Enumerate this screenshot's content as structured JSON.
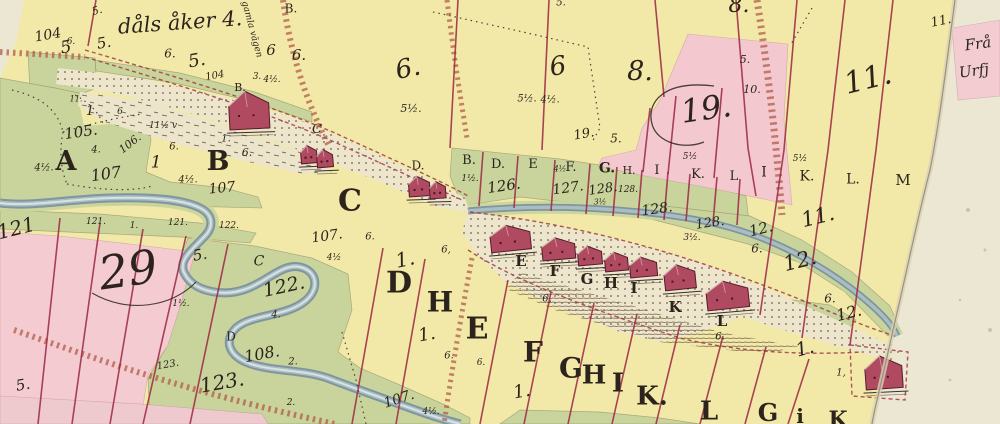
{
  "meta": {
    "document_type": "historical hand-drawn cadastral map (scanned sheet)",
    "main_inscription": "dåls åker 4.",
    "road_inscription": "gamla vägen",
    "neighbor_sheet_text": [
      "Frå",
      "Urfj"
    ]
  },
  "palette": {
    "paper": "#ece7d2",
    "field_yellow": "#f2e9a9",
    "meadow_green": "#c8d49b",
    "parcel_pink": "#f3cbd1",
    "boundary_red": "#9e2b45",
    "road_brown": "#b05844",
    "river_gray": "#7f969e",
    "house_red": "#b04a60",
    "ink": "#2c241c"
  },
  "map": {
    "labels": [
      {
        "t": "5.",
        "x": 97,
        "y": 11,
        "s": 11,
        "r": -15
      },
      {
        "t": "dåls åker 4.",
        "x": 180,
        "y": 24,
        "s": 21,
        "r": -4
      },
      {
        "t": "B.",
        "x": 291,
        "y": 9,
        "s": 12,
        "u": 1
      },
      {
        "t": "104",
        "x": 48,
        "y": 36,
        "s": 14,
        "r": -10
      },
      {
        "t": "6.",
        "x": 71,
        "y": 43,
        "s": 9
      },
      {
        "t": "5",
        "x": 66,
        "y": 49,
        "s": 17,
        "r": -10
      },
      {
        "t": "5.",
        "x": 104,
        "y": 44,
        "s": 15,
        "r": -10
      },
      {
        "t": "6.",
        "x": 170,
        "y": 54,
        "s": 12
      },
      {
        "t": "5.",
        "x": 197,
        "y": 62,
        "s": 18,
        "r": -10
      },
      {
        "t": "104",
        "x": 215,
        "y": 77,
        "s": 10,
        "r": -10
      },
      {
        "t": "gamla vägen",
        "x": 251,
        "y": 30,
        "s": 9,
        "r": 75
      },
      {
        "t": "6",
        "x": 271,
        "y": 51,
        "s": 15
      },
      {
        "t": "6.",
        "x": 299,
        "y": 56,
        "s": 15
      },
      {
        "t": "3.",
        "x": 257,
        "y": 78,
        "s": 9
      },
      {
        "t": "4½.",
        "x": 272,
        "y": 81,
        "s": 9
      },
      {
        "t": "B.",
        "x": 240,
        "y": 88,
        "s": 11,
        "u": 1
      },
      {
        "t": "6.",
        "x": 408,
        "y": 70,
        "s": 26,
        "r": -12
      },
      {
        "t": "5½.",
        "x": 411,
        "y": 109,
        "s": 11
      },
      {
        "t": "6",
        "x": 558,
        "y": 68,
        "s": 26,
        "r": -8
      },
      {
        "t": "5½.",
        "x": 527,
        "y": 100,
        "s": 10
      },
      {
        "t": "4½.",
        "x": 550,
        "y": 101,
        "s": 10
      },
      {
        "t": "8.",
        "x": 640,
        "y": 73,
        "s": 27
      },
      {
        "t": "5.",
        "x": 561,
        "y": 4,
        "s": 10
      },
      {
        "t": "8.",
        "x": 739,
        "y": 7,
        "s": 22
      },
      {
        "t": "5.",
        "x": 745,
        "y": 60,
        "s": 11
      },
      {
        "t": "19.",
        "x": 584,
        "y": 135,
        "s": 13,
        "r": -10
      },
      {
        "t": "5.",
        "x": 616,
        "y": 139,
        "s": 12
      },
      {
        "t": "19.",
        "x": 706,
        "y": 110,
        "s": 32,
        "r": -8
      },
      {
        "t": "10.",
        "x": 752,
        "y": 90,
        "s": 11
      },
      {
        "t": "11.",
        "x": 941,
        "y": 22,
        "s": 13,
        "r": -12
      },
      {
        "t": "11.",
        "x": 868,
        "y": 81,
        "s": 30,
        "r": -14
      },
      {
        "t": "Frå",
        "x": 978,
        "y": 45,
        "s": 15,
        "r": -8
      },
      {
        "t": "Urfj",
        "x": 974,
        "y": 72,
        "s": 15,
        "r": -8
      },
      {
        "t": "11.",
        "x": 76,
        "y": 100,
        "s": 8
      },
      {
        "t": "1",
        "x": 90,
        "y": 112,
        "s": 13
      },
      {
        "t": "6",
        "x": 120,
        "y": 113,
        "s": 9
      },
      {
        "t": "105.",
        "x": 81,
        "y": 133,
        "s": 15,
        "r": -8
      },
      {
        "t": "106.",
        "x": 130,
        "y": 144,
        "s": 11,
        "r": -38
      },
      {
        "t": "11½ v",
        "x": 163,
        "y": 127,
        "s": 9
      },
      {
        "t": "A",
        "x": 66,
        "y": 163,
        "s": 27,
        "b": 1,
        "u": 1
      },
      {
        "t": "4½.",
        "x": 44,
        "y": 169,
        "s": 10
      },
      {
        "t": "4.",
        "x": 96,
        "y": 151,
        "s": 10
      },
      {
        "t": "107",
        "x": 106,
        "y": 175,
        "s": 16,
        "r": -8
      },
      {
        "t": "6.",
        "x": 174,
        "y": 148,
        "s": 10
      },
      {
        "t": "1",
        "x": 156,
        "y": 164,
        "s": 17
      },
      {
        "t": "1.",
        "x": 226,
        "y": 140,
        "s": 10
      },
      {
        "t": "B",
        "x": 218,
        "y": 163,
        "s": 27,
        "b": 1,
        "u": 1
      },
      {
        "t": "6.",
        "x": 247,
        "y": 153,
        "s": 11
      },
      {
        "t": "4½.",
        "x": 188,
        "y": 181,
        "s": 10
      },
      {
        "t": "107",
        "x": 222,
        "y": 189,
        "s": 14,
        "r": -6
      },
      {
        "t": "C",
        "x": 317,
        "y": 130,
        "s": 13
      },
      {
        "t": "121",
        "x": 16,
        "y": 229,
        "s": 20,
        "r": -14
      },
      {
        "t": "121.",
        "x": 96,
        "y": 223,
        "s": 9
      },
      {
        "t": "1.",
        "x": 134,
        "y": 227,
        "s": 9
      },
      {
        "t": "121.",
        "x": 178,
        "y": 224,
        "s": 9
      },
      {
        "t": "122.",
        "x": 229,
        "y": 227,
        "s": 9
      },
      {
        "t": "29",
        "x": 128,
        "y": 272,
        "s": 46,
        "r": -8
      },
      {
        "t": "5.",
        "x": 200,
        "y": 256,
        "s": 15,
        "r": -10
      },
      {
        "t": "1½.",
        "x": 181,
        "y": 305,
        "s": 9
      },
      {
        "t": "C",
        "x": 259,
        "y": 262,
        "s": 14
      },
      {
        "t": "122.",
        "x": 284,
        "y": 288,
        "s": 19,
        "r": -12
      },
      {
        "t": "4.",
        "x": 276,
        "y": 316,
        "s": 10
      },
      {
        "t": "D",
        "x": 231,
        "y": 337,
        "s": 12,
        "u": 1
      },
      {
        "t": "108.",
        "x": 262,
        "y": 355,
        "s": 16,
        "r": -10
      },
      {
        "t": "2.",
        "x": 293,
        "y": 363,
        "s": 10
      },
      {
        "t": "123.",
        "x": 168,
        "y": 366,
        "s": 10,
        "r": -10
      },
      {
        "t": "123.",
        "x": 222,
        "y": 383,
        "s": 20,
        "r": -10
      },
      {
        "t": "5.",
        "x": 23,
        "y": 386,
        "s": 15,
        "r": -10
      },
      {
        "t": "2.",
        "x": 291,
        "y": 404,
        "s": 9
      },
      {
        "t": "C",
        "x": 350,
        "y": 203,
        "s": 30,
        "b": 1,
        "u": 1
      },
      {
        "t": "107.",
        "x": 327,
        "y": 237,
        "s": 14,
        "r": -8
      },
      {
        "t": "6.",
        "x": 370,
        "y": 238,
        "s": 10
      },
      {
        "t": "4½",
        "x": 334,
        "y": 259,
        "s": 9
      },
      {
        "t": "D.",
        "x": 418,
        "y": 166,
        "s": 12,
        "u": 1
      },
      {
        "t": "B.",
        "x": 469,
        "y": 161,
        "s": 13,
        "u": 1
      },
      {
        "t": "1½.",
        "x": 470,
        "y": 180,
        "s": 9
      },
      {
        "t": "D.",
        "x": 498,
        "y": 165,
        "s": 13,
        "u": 1
      },
      {
        "t": "126.",
        "x": 504,
        "y": 187,
        "s": 15,
        "r": -8
      },
      {
        "t": "E",
        "x": 533,
        "y": 165,
        "s": 13,
        "u": 1
      },
      {
        "t": "4½",
        "x": 560,
        "y": 170,
        "s": 8
      },
      {
        "t": "F.",
        "x": 571,
        "y": 168,
        "s": 13,
        "u": 1
      },
      {
        "t": "127.",
        "x": 568,
        "y": 189,
        "s": 14,
        "r": -8
      },
      {
        "t": "G.",
        "x": 607,
        "y": 169,
        "s": 14,
        "b": 1,
        "u": 1
      },
      {
        "t": "128.",
        "x": 603,
        "y": 190,
        "s": 13,
        "r": -8
      },
      {
        "t": "H.",
        "x": 629,
        "y": 171,
        "s": 11,
        "u": 1
      },
      {
        "t": "128.",
        "x": 628,
        "y": 191,
        "s": 9
      },
      {
        "t": "3½",
        "x": 600,
        "y": 203,
        "s": 8
      },
      {
        "t": "128.",
        "x": 657,
        "y": 210,
        "s": 14,
        "r": -8
      },
      {
        "t": "128.",
        "x": 710,
        "y": 224,
        "s": 13,
        "r": -8
      },
      {
        "t": "3½.",
        "x": 692,
        "y": 239,
        "s": 9
      },
      {
        "t": "I",
        "x": 657,
        "y": 171,
        "s": 13,
        "u": 1
      },
      {
        "t": "K.",
        "x": 698,
        "y": 175,
        "s": 13,
        "u": 1
      },
      {
        "t": "L",
        "x": 734,
        "y": 177,
        "s": 13,
        "u": 1
      },
      {
        "t": "5½",
        "x": 690,
        "y": 158,
        "s": 9
      },
      {
        "t": "I",
        "x": 764,
        "y": 173,
        "s": 14,
        "u": 1
      },
      {
        "t": "K.",
        "x": 807,
        "y": 177,
        "s": 14,
        "u": 1
      },
      {
        "t": "L.",
        "x": 853,
        "y": 180,
        "s": 14,
        "u": 1
      },
      {
        "t": "M",
        "x": 903,
        "y": 181,
        "s": 15,
        "u": 1
      },
      {
        "t": "5½",
        "x": 800,
        "y": 160,
        "s": 9
      },
      {
        "t": "11.",
        "x": 818,
        "y": 218,
        "s": 21,
        "r": -14
      },
      {
        "t": "12.",
        "x": 761,
        "y": 230,
        "s": 15,
        "r": -14
      },
      {
        "t": "6.",
        "x": 757,
        "y": 249,
        "s": 12
      },
      {
        "t": "12.",
        "x": 800,
        "y": 262,
        "s": 21,
        "r": -14
      },
      {
        "t": "6.",
        "x": 830,
        "y": 299,
        "s": 12
      },
      {
        "t": "12.",
        "x": 849,
        "y": 314,
        "s": 16,
        "r": -14
      },
      {
        "t": "1.",
        "x": 805,
        "y": 350,
        "s": 19,
        "r": -15
      },
      {
        "t": "1,",
        "x": 841,
        "y": 374,
        "s": 10
      },
      {
        "t": "E",
        "x": 521,
        "y": 262,
        "s": 15,
        "b": 1,
        "u": 1
      },
      {
        "t": "F",
        "x": 555,
        "y": 272,
        "s": 15,
        "b": 1,
        "u": 1
      },
      {
        "t": "G",
        "x": 587,
        "y": 280,
        "s": 15,
        "b": 1,
        "u": 1
      },
      {
        "t": "H",
        "x": 611,
        "y": 284,
        "s": 15,
        "b": 1,
        "u": 1
      },
      {
        "t": "I",
        "x": 634,
        "y": 289,
        "s": 15,
        "b": 1,
        "u": 1
      },
      {
        "t": "K",
        "x": 675,
        "y": 308,
        "s": 15,
        "b": 1,
        "u": 1
      },
      {
        "t": "L",
        "x": 722,
        "y": 322,
        "s": 15,
        "b": 1,
        "u": 1
      },
      {
        "t": "1.",
        "x": 405,
        "y": 260,
        "s": 20,
        "r": -12
      },
      {
        "t": "D",
        "x": 399,
        "y": 285,
        "s": 30,
        "b": 1,
        "u": 1
      },
      {
        "t": "6,",
        "x": 446,
        "y": 251,
        "s": 10
      },
      {
        "t": "H",
        "x": 440,
        "y": 304,
        "s": 28,
        "b": 1,
        "u": 1
      },
      {
        "t": "1.",
        "x": 427,
        "y": 336,
        "s": 18,
        "r": -10
      },
      {
        "t": "E",
        "x": 477,
        "y": 331,
        "s": 30,
        "b": 1,
        "u": 1
      },
      {
        "t": "6.",
        "x": 449,
        "y": 357,
        "s": 10
      },
      {
        "t": "6.",
        "x": 481,
        "y": 364,
        "s": 9
      },
      {
        "t": "F",
        "x": 533,
        "y": 354,
        "s": 28,
        "b": 1,
        "u": 1
      },
      {
        "t": "1.",
        "x": 522,
        "y": 393,
        "s": 18,
        "r": -10
      },
      {
        "t": "6,",
        "x": 547,
        "y": 300,
        "s": 10
      },
      {
        "t": "G",
        "x": 571,
        "y": 370,
        "s": 28,
        "b": 1,
        "u": 1
      },
      {
        "t": "H",
        "x": 594,
        "y": 377,
        "s": 26,
        "b": 1,
        "u": 1
      },
      {
        "t": "I",
        "x": 618,
        "y": 385,
        "s": 26,
        "b": 1,
        "u": 1
      },
      {
        "t": "K.",
        "x": 652,
        "y": 398,
        "s": 26,
        "b": 1,
        "u": 1
      },
      {
        "t": "L",
        "x": 709,
        "y": 413,
        "s": 26,
        "b": 1,
        "u": 1
      },
      {
        "t": "6.",
        "x": 720,
        "y": 338,
        "s": 10
      },
      {
        "t": "G",
        "x": 768,
        "y": 414,
        "s": 24,
        "b": 1,
        "u": 1
      },
      {
        "t": "i",
        "x": 800,
        "y": 417,
        "s": 20,
        "b": 1,
        "u": 1
      },
      {
        "t": "K",
        "x": 838,
        "y": 421,
        "s": 22,
        "b": 1,
        "u": 1
      },
      {
        "t": "107.",
        "x": 399,
        "y": 400,
        "s": 14,
        "r": -18
      },
      {
        "t": "4½.",
        "x": 431,
        "y": 413,
        "s": 9
      }
    ],
    "houses": [
      {
        "x": 228,
        "y": 92,
        "w": 40,
        "h": 38,
        "r": -3
      },
      {
        "x": 300,
        "y": 146,
        "w": 16,
        "h": 18,
        "r": -5
      },
      {
        "x": 316,
        "y": 150,
        "w": 16,
        "h": 18,
        "r": -5
      },
      {
        "x": 408,
        "y": 177,
        "w": 21,
        "h": 20,
        "r": -4
      },
      {
        "x": 429,
        "y": 182,
        "w": 16,
        "h": 17,
        "r": -4
      },
      {
        "x": 489,
        "y": 227,
        "w": 40,
        "h": 26,
        "r": -6
      },
      {
        "x": 541,
        "y": 239,
        "w": 33,
        "h": 22,
        "r": -5
      },
      {
        "x": 577,
        "y": 247,
        "w": 24,
        "h": 19,
        "r": -5
      },
      {
        "x": 604,
        "y": 253,
        "w": 23,
        "h": 19,
        "r": -5
      },
      {
        "x": 629,
        "y": 258,
        "w": 27,
        "h": 20,
        "r": -5
      },
      {
        "x": 663,
        "y": 266,
        "w": 31,
        "h": 25,
        "r": -6
      },
      {
        "x": 705,
        "y": 283,
        "w": 42,
        "h": 28,
        "r": -6
      },
      {
        "x": 864,
        "y": 357,
        "w": 37,
        "h": 33,
        "r": -4
      }
    ],
    "icons": {
      "house-icon": "dark-red gabled building symbol",
      "river": "gray-blue watercourse band",
      "road": "brown hatched double-dash band"
    }
  }
}
